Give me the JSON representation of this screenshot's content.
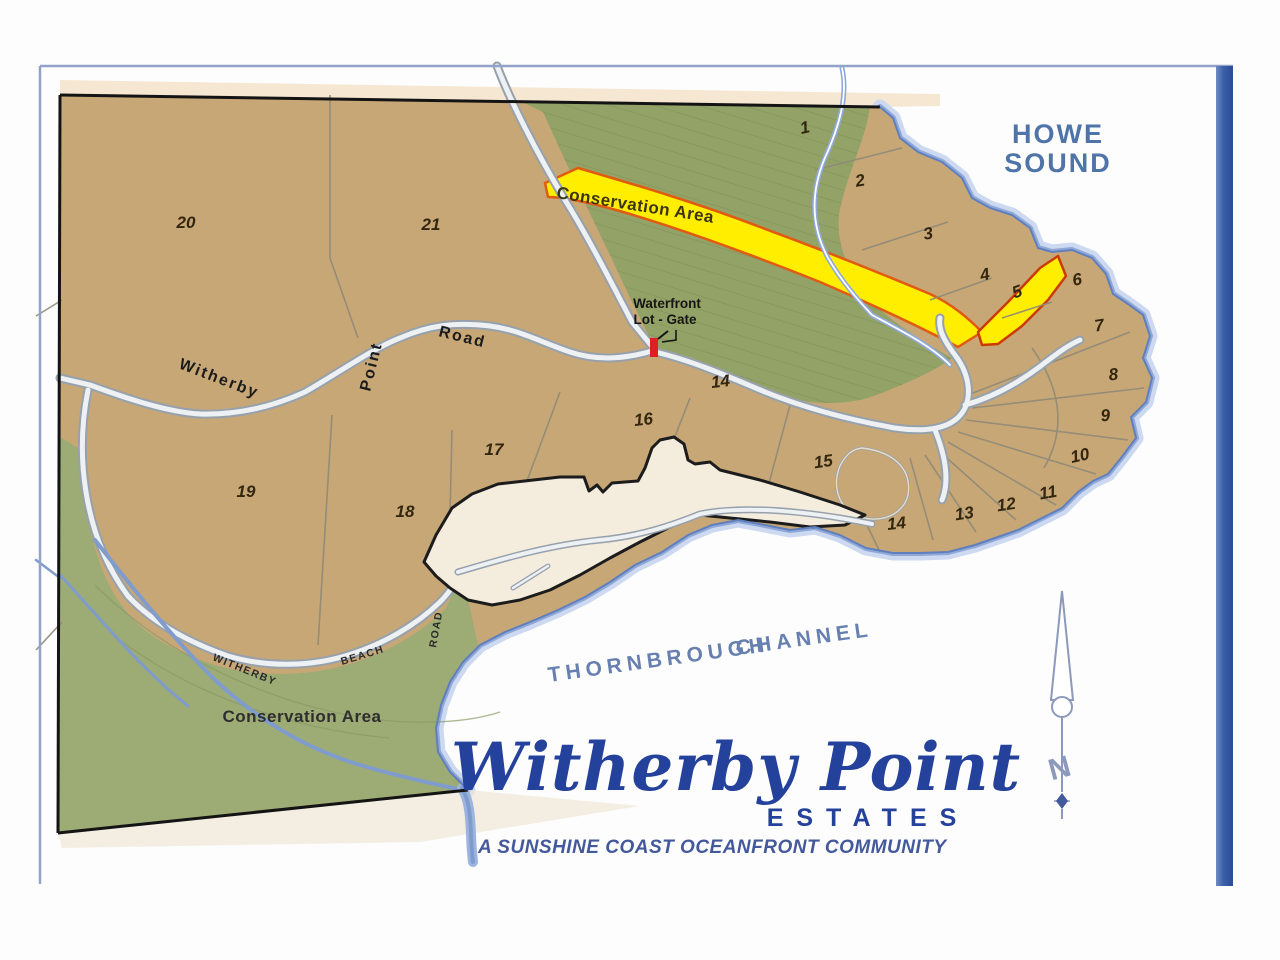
{
  "map": {
    "region_labels": {
      "howe_sound_1": "HOWE",
      "howe_sound_2": "SOUND",
      "channel_1": "THORNBROUGH",
      "channel_2": "CHANNEL",
      "conservation_top": "Conservation Area",
      "conservation_bottom": "Conservation Area"
    },
    "road_labels": {
      "witherby": "Witherby",
      "point": "Point",
      "road": "Road",
      "beach_1": "WITHERBY",
      "beach_2": "BEACH",
      "beach_3": "ROAD"
    },
    "gate_label": {
      "line1": "Waterfront",
      "line2": "Lot - Gate"
    },
    "compass_n": "N",
    "lots": [
      {
        "label": "20",
        "x": 186,
        "y": 228
      },
      {
        "label": "21",
        "x": 431,
        "y": 230
      },
      {
        "label": "1",
        "x": 806,
        "y": 133,
        "r": -12
      },
      {
        "label": "2",
        "x": 861,
        "y": 186,
        "r": -10
      },
      {
        "label": "3",
        "x": 929,
        "y": 239,
        "r": -10
      },
      {
        "label": "4",
        "x": 986,
        "y": 280,
        "r": -12
      },
      {
        "label": "5",
        "x": 1019,
        "y": 297,
        "r": -20
      },
      {
        "label": "6",
        "x": 1078,
        "y": 285,
        "r": -10
      },
      {
        "label": "7",
        "x": 1100,
        "y": 331,
        "r": -8
      },
      {
        "label": "8",
        "x": 1114,
        "y": 380,
        "r": -6
      },
      {
        "label": "9",
        "x": 1106,
        "y": 421,
        "r": -6
      },
      {
        "label": "10",
        "x": 1081,
        "y": 461,
        "r": -12
      },
      {
        "label": "11",
        "x": 1049,
        "y": 498,
        "r": -10
      },
      {
        "label": "12",
        "x": 1007,
        "y": 510,
        "r": -8
      },
      {
        "label": "13",
        "x": 965,
        "y": 519,
        "r": -8
      },
      {
        "label": "14",
        "x": 897,
        "y": 529,
        "r": -6
      },
      {
        "label": "15",
        "x": 824,
        "y": 467,
        "r": -8
      },
      {
        "label": "14",
        "x": 721,
        "y": 387,
        "r": -6
      },
      {
        "label": "16",
        "x": 644,
        "y": 425,
        "r": -6
      },
      {
        "label": "17",
        "x": 494,
        "y": 455
      },
      {
        "label": "18",
        "x": 405,
        "y": 517
      },
      {
        "label": "19",
        "x": 246,
        "y": 497
      }
    ]
  },
  "title_block": {
    "name_script": "Witherby Point",
    "estates": "ESTATES",
    "tagline": "A SUNSHINE COAST OCEANFRONT COMMUNITY"
  },
  "colors": {
    "land_tan": "#c8a777",
    "conservation_green": "#9dab75",
    "highlight_yellow": "#ffee00",
    "highlight_border_orange": "#e05a10",
    "coast_blue": "#8fa8d8",
    "navy_title": "#24419b",
    "howe_sound_blue": "#4f74a8",
    "frame_bar_blue": "#3a5fa8",
    "gate_red": "#e02020"
  }
}
